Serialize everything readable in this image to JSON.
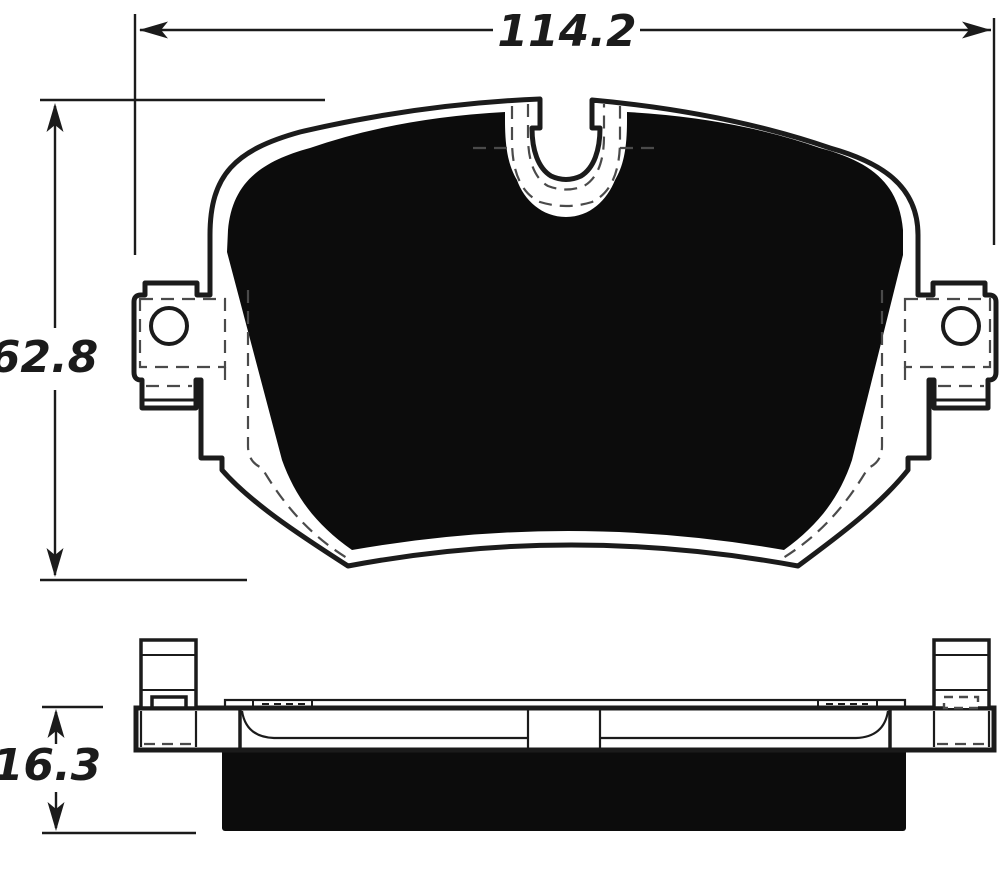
{
  "drawing": {
    "dimensions": {
      "width_mm": "114.2",
      "height_mm": "62.8",
      "thickness_mm": "16.3"
    },
    "colors": {
      "line": "#1b1b1b",
      "dashed_line": "#4a4a4a",
      "friction_fill": "#0c0c0c",
      "background": "#ffffff"
    }
  }
}
